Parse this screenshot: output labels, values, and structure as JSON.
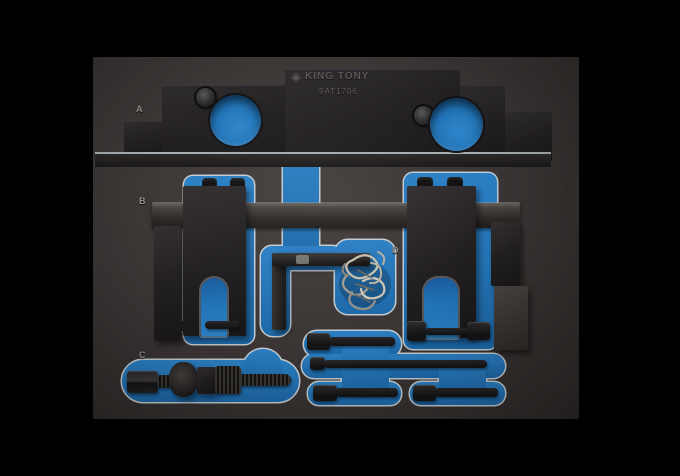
{
  "tray": {
    "brand": "KING TONY",
    "model": "9AT1706",
    "logo_glyph": "◈",
    "compartment_labels": {
      "a": "A",
      "b": "B",
      "c": "C",
      "d": "D"
    },
    "colors": {
      "background": "#000000",
      "foam": "#3a3534",
      "pocket_blue": "#2174b8",
      "cut_edge_outline": "#c3c9ce",
      "tool_metal": "#232021",
      "chain_silver": "#c9c2b1"
    }
  }
}
